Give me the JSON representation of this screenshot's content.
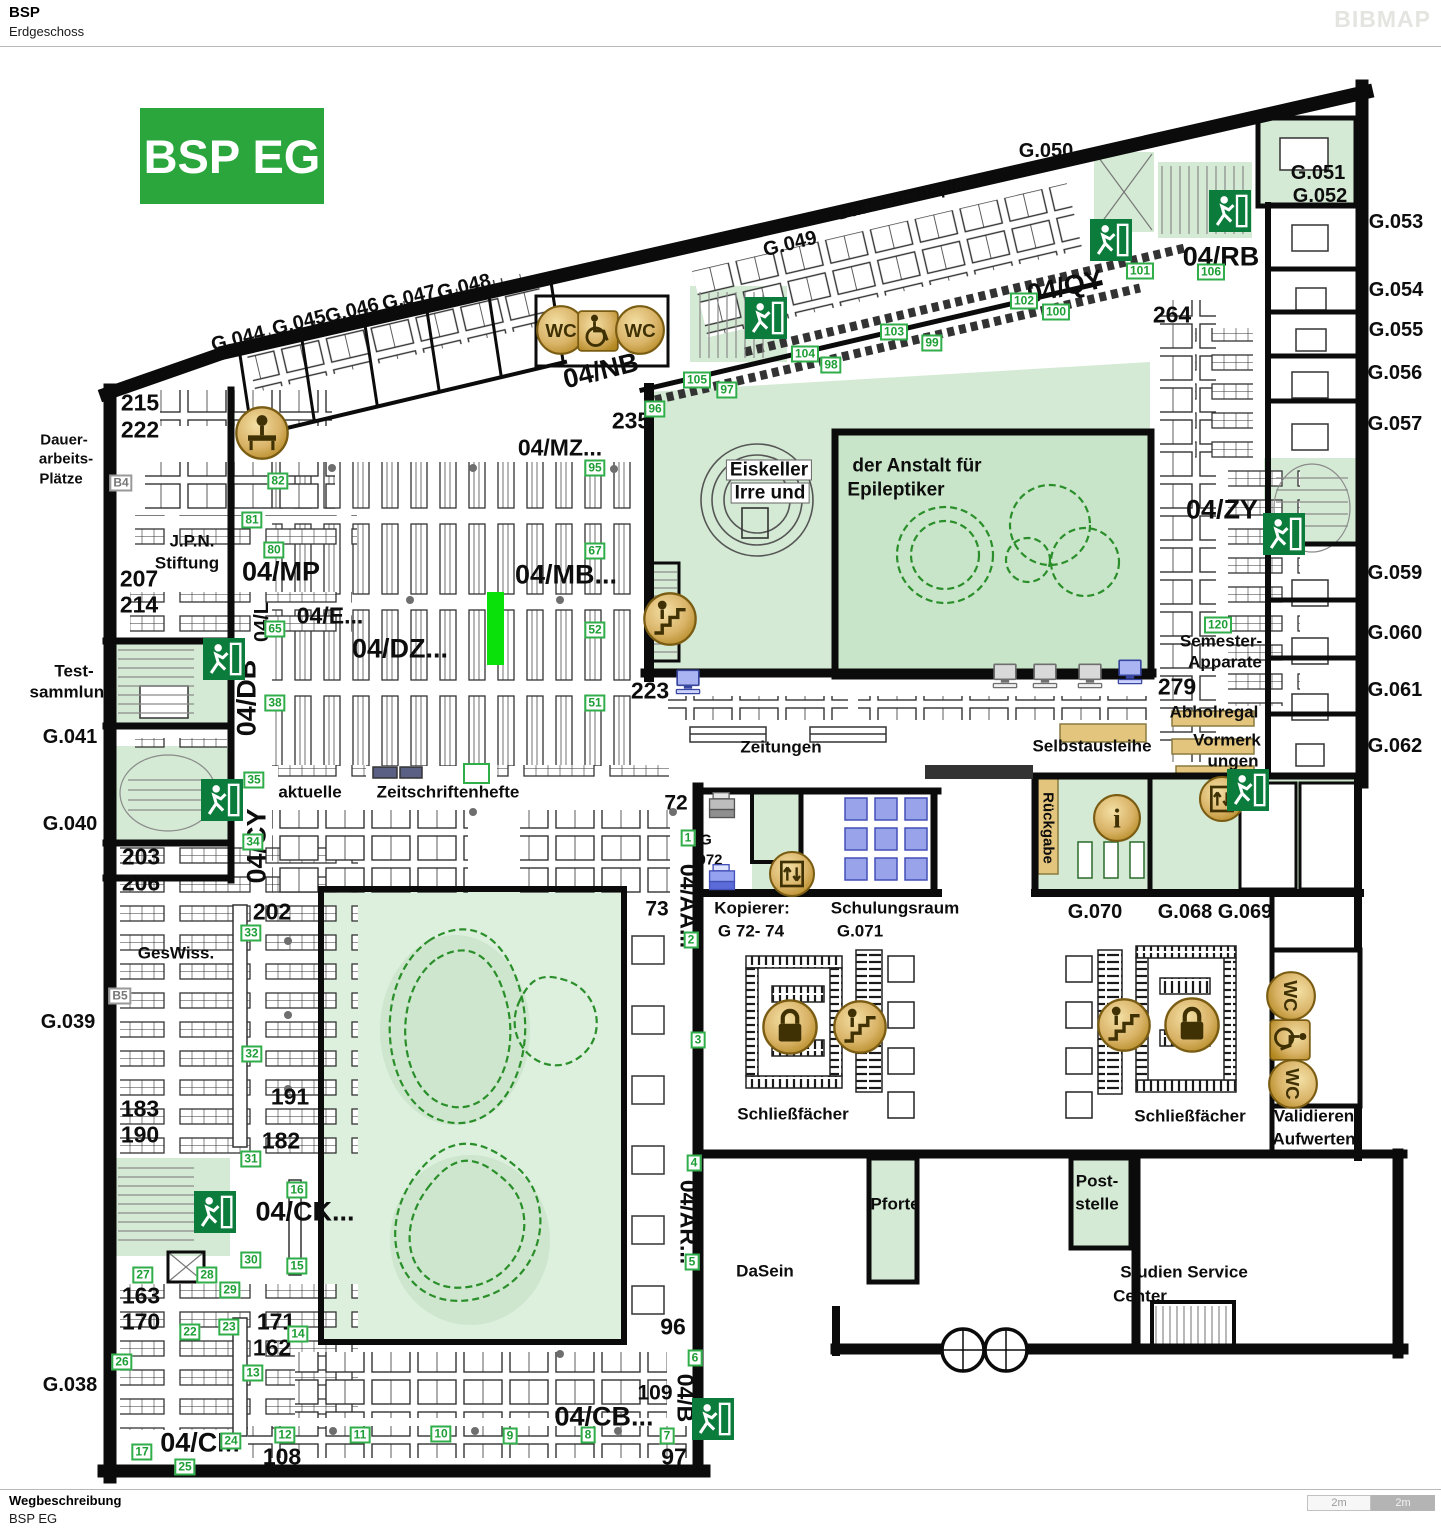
{
  "header": {
    "title": "BSP",
    "subtitle": "Erdgeschoss",
    "logo": "BIBMAP"
  },
  "footer": {
    "heading": "Wegbeschreibung",
    "text": "BSP EG",
    "scale": [
      "2m",
      "2m"
    ]
  },
  "map": {
    "badge": "BSP EG",
    "highlight_color": "#0ae10a",
    "labels": [
      {
        "t": "G.044",
        "x": 238,
        "y": 339,
        "c": "rm",
        "r": -14
      },
      {
        "t": "G.045",
        "x": 299,
        "y": 323,
        "c": "rm",
        "r": -14
      },
      {
        "t": "G.046",
        "x": 352,
        "y": 311,
        "c": "rm",
        "r": -14
      },
      {
        "t": "G.047",
        "x": 409,
        "y": 298,
        "c": "rm",
        "r": -14
      },
      {
        "t": "G.048",
        "x": 464,
        "y": 287,
        "c": "rm",
        "r": -14
      },
      {
        "t": "G.049",
        "x": 790,
        "y": 244,
        "c": "rm",
        "r": -14
      },
      {
        "t": "Dauerarbeitsplätze",
        "x": 912,
        "y": 196,
        "c": "tx",
        "r": -14
      },
      {
        "t": "G.050",
        "x": 1046,
        "y": 151,
        "c": "rm"
      },
      {
        "t": "G.051",
        "x": 1318,
        "y": 173,
        "c": "rm"
      },
      {
        "t": "G.052",
        "x": 1320,
        "y": 196,
        "c": "rm"
      },
      {
        "t": "G.053",
        "x": 1396,
        "y": 222,
        "c": "rm"
      },
      {
        "t": "G.054",
        "x": 1396,
        "y": 290,
        "c": "rm"
      },
      {
        "t": "G.055",
        "x": 1396,
        "y": 330,
        "c": "rm"
      },
      {
        "t": "G.056",
        "x": 1395,
        "y": 373,
        "c": "rm"
      },
      {
        "t": "G.057",
        "x": 1395,
        "y": 424,
        "c": "rm"
      },
      {
        "t": "G.059",
        "x": 1395,
        "y": 573,
        "c": "rm"
      },
      {
        "t": "G.060",
        "x": 1395,
        "y": 633,
        "c": "rm"
      },
      {
        "t": "G.061",
        "x": 1395,
        "y": 690,
        "c": "rm"
      },
      {
        "t": "G.062",
        "x": 1395,
        "y": 746,
        "c": "rm"
      },
      {
        "t": "215",
        "x": 140,
        "y": 403,
        "c": "n1"
      },
      {
        "t": "222",
        "x": 140,
        "y": 430,
        "c": "n1"
      },
      {
        "t": "Dauer-",
        "x": 64,
        "y": 440,
        "c": "t2"
      },
      {
        "t": "arbeits-",
        "x": 66,
        "y": 459,
        "c": "t2"
      },
      {
        "t": "Plätze",
        "x": 61,
        "y": 479,
        "c": "t2"
      },
      {
        "t": "J.P.N.",
        "x": 192,
        "y": 541,
        "c": "tx"
      },
      {
        "t": "Stiftung",
        "x": 187,
        "y": 563,
        "c": "tx"
      },
      {
        "t": "207",
        "x": 139,
        "y": 579,
        "c": "n1"
      },
      {
        "t": "214",
        "x": 139,
        "y": 605,
        "c": "n1"
      },
      {
        "t": "Test-",
        "x": 74,
        "y": 671,
        "c": "tx"
      },
      {
        "t": "sammlung",
        "x": 72,
        "y": 692,
        "c": "tx"
      },
      {
        "t": "G.041",
        "x": 70,
        "y": 737,
        "c": "rm"
      },
      {
        "t": "G.040",
        "x": 70,
        "y": 824,
        "c": "rm"
      },
      {
        "t": "203",
        "x": 141,
        "y": 857,
        "c": "n1"
      },
      {
        "t": "206",
        "x": 141,
        "y": 883,
        "c": "n1"
      },
      {
        "t": "GesWiss.",
        "x": 176,
        "y": 953,
        "c": "tx"
      },
      {
        "t": "G.039",
        "x": 68,
        "y": 1022,
        "c": "rm"
      },
      {
        "t": "183",
        "x": 140,
        "y": 1109,
        "c": "n1"
      },
      {
        "t": "190",
        "x": 140,
        "y": 1135,
        "c": "n1"
      },
      {
        "t": "163",
        "x": 141,
        "y": 1296,
        "c": "n1"
      },
      {
        "t": "170",
        "x": 141,
        "y": 1322,
        "c": "n1"
      },
      {
        "t": "G.038",
        "x": 70,
        "y": 1385,
        "c": "rm"
      },
      {
        "t": "04/NB",
        "x": 601,
        "y": 371,
        "c": "b1",
        "r": -14
      },
      {
        "t": "235",
        "x": 631,
        "y": 421,
        "c": "n1"
      },
      {
        "t": "04/MZ...",
        "x": 560,
        "y": 448,
        "c": "b2"
      },
      {
        "t": "04/QY",
        "x": 1065,
        "y": 287,
        "c": "b1",
        "r": -12
      },
      {
        "t": "04/RB",
        "x": 1221,
        "y": 257,
        "c": "b1"
      },
      {
        "t": "264",
        "x": 1172,
        "y": 315,
        "c": "n1"
      },
      {
        "t": "Eiskeller",
        "x": 769,
        "y": 470,
        "c": "chip"
      },
      {
        "t": "Irre  und",
        "x": 770,
        "y": 493,
        "c": "chip"
      },
      {
        "t": "der Anstalt für",
        "x": 917,
        "y": 466,
        "c": "tx3"
      },
      {
        "t": "Epileptiker",
        "x": 896,
        "y": 490,
        "c": "tx3"
      },
      {
        "t": "04/MP",
        "x": 281,
        "y": 572,
        "c": "b1"
      },
      {
        "t": "04/MB...",
        "x": 566,
        "y": 575,
        "c": "b1"
      },
      {
        "t": "04/E...",
        "x": 330,
        "y": 616,
        "c": "b2"
      },
      {
        "t": "04/DZ...",
        "x": 400,
        "y": 649,
        "c": "b1"
      },
      {
        "t": "04/L",
        "x": 262,
        "y": 622,
        "c": "b3",
        "r": -90
      },
      {
        "t": "04/DB",
        "x": 247,
        "y": 698,
        "c": "b1",
        "r": -90
      },
      {
        "t": "04/CY",
        "x": 257,
        "y": 846,
        "c": "b1",
        "r": -90
      },
      {
        "t": "223",
        "x": 650,
        "y": 691,
        "c": "n1"
      },
      {
        "t": "279",
        "x": 1177,
        "y": 687,
        "c": "n1"
      },
      {
        "t": "04/ZY",
        "x": 1222,
        "y": 510,
        "c": "b1"
      },
      {
        "t": "Semester-",
        "x": 1221,
        "y": 641,
        "c": "tx"
      },
      {
        "t": "Apparate",
        "x": 1225,
        "y": 662,
        "c": "tx"
      },
      {
        "t": "Abholregal",
        "x": 1214,
        "y": 712,
        "c": "tx"
      },
      {
        "t": "Vormerk",
        "x": 1227,
        "y": 740,
        "c": "tx"
      },
      {
        "t": "ungen",
        "x": 1233,
        "y": 761,
        "c": "tx"
      },
      {
        "t": "Selbstausleihe",
        "x": 1092,
        "y": 746,
        "c": "tx"
      },
      {
        "t": "Zeitungen",
        "x": 781,
        "y": 747,
        "c": "tx"
      },
      {
        "t": "aktuelle",
        "x": 310,
        "y": 792,
        "c": "tx"
      },
      {
        "t": "Zeitschriftenhefte",
        "x": 448,
        "y": 792,
        "c": "tx"
      },
      {
        "t": "72",
        "x": 676,
        "y": 803,
        "c": "n2"
      },
      {
        "t": "G",
        "x": 706,
        "y": 840,
        "c": "t2"
      },
      {
        "t": "072",
        "x": 710,
        "y": 860,
        "c": "t2"
      },
      {
        "t": "73",
        "x": 657,
        "y": 909,
        "c": "n2"
      },
      {
        "t": "04/AA...",
        "x": 688,
        "y": 906,
        "c": "b2",
        "r": 90
      },
      {
        "t": "Kopierer:",
        "x": 752,
        "y": 908,
        "c": "tx"
      },
      {
        "t": "G 72- 74",
        "x": 751,
        "y": 931,
        "c": "tx"
      },
      {
        "t": "Schulungsraum",
        "x": 895,
        "y": 908,
        "c": "tx"
      },
      {
        "t": "G.071",
        "x": 860,
        "y": 931,
        "c": "tx"
      },
      {
        "t": "Rückgabe",
        "x": 1048,
        "y": 828,
        "c": "t2",
        "r": 90
      },
      {
        "t": "G.070",
        "x": 1095,
        "y": 912,
        "c": "rm"
      },
      {
        "t": "G.068 G.069",
        "x": 1215,
        "y": 912,
        "c": "rm"
      },
      {
        "t": "Schließfächer",
        "x": 793,
        "y": 1114,
        "c": "tx"
      },
      {
        "t": "Schließfächer",
        "x": 1190,
        "y": 1116,
        "c": "tx"
      },
      {
        "t": "Validieren",
        "x": 1314,
        "y": 1116,
        "c": "tx"
      },
      {
        "t": "Aufwerten",
        "x": 1314,
        "y": 1139,
        "c": "tx"
      },
      {
        "t": "202",
        "x": 272,
        "y": 912,
        "c": "n1"
      },
      {
        "t": "191",
        "x": 290,
        "y": 1097,
        "c": "n1"
      },
      {
        "t": "182",
        "x": 281,
        "y": 1141,
        "c": "n1"
      },
      {
        "t": "04/CK...",
        "x": 305,
        "y": 1212,
        "c": "b1"
      },
      {
        "t": "171",
        "x": 276,
        "y": 1322,
        "c": "n1"
      },
      {
        "t": "162",
        "x": 272,
        "y": 1348,
        "c": "n1"
      },
      {
        "t": "04/CM",
        "x": 200,
        "y": 1443,
        "c": "b1"
      },
      {
        "t": "108",
        "x": 282,
        "y": 1457,
        "c": "n1"
      },
      {
        "t": "04/CB...",
        "x": 604,
        "y": 1417,
        "c": "b1"
      },
      {
        "t": "109",
        "x": 655,
        "y": 1393,
        "c": "n2"
      },
      {
        "t": "97",
        "x": 674,
        "y": 1457,
        "c": "n1"
      },
      {
        "t": "96",
        "x": 673,
        "y": 1327,
        "c": "n1"
      },
      {
        "t": "04/B",
        "x": 685,
        "y": 1398,
        "c": "b2",
        "r": 90
      },
      {
        "t": "04/AR...",
        "x": 688,
        "y": 1222,
        "c": "b2",
        "r": 90
      },
      {
        "t": "Pforte",
        "x": 895,
        "y": 1204,
        "c": "tx"
      },
      {
        "t": "DaSein",
        "x": 765,
        "y": 1271,
        "c": "tx"
      },
      {
        "t": "Post-",
        "x": 1097,
        "y": 1181,
        "c": "tx"
      },
      {
        "t": "stelle",
        "x": 1097,
        "y": 1204,
        "c": "tx"
      },
      {
        "t": "Studien Service",
        "x": 1184,
        "y": 1272,
        "c": "tx"
      },
      {
        "t": "Center",
        "x": 1140,
        "y": 1296,
        "c": "tx"
      }
    ],
    "markers": [
      {
        "t": "82",
        "x": 278,
        "y": 481
      },
      {
        "t": "81",
        "x": 252,
        "y": 520
      },
      {
        "t": "80",
        "x": 274,
        "y": 550
      },
      {
        "t": "95",
        "x": 595,
        "y": 468
      },
      {
        "t": "96",
        "x": 655,
        "y": 409
      },
      {
        "t": "105",
        "x": 697,
        "y": 380
      },
      {
        "t": "97",
        "x": 727,
        "y": 390
      },
      {
        "t": "104",
        "x": 805,
        "y": 354
      },
      {
        "t": "98",
        "x": 831,
        "y": 365
      },
      {
        "t": "103",
        "x": 894,
        "y": 332
      },
      {
        "t": "99",
        "x": 932,
        "y": 343
      },
      {
        "t": "102",
        "x": 1024,
        "y": 301
      },
      {
        "t": "100",
        "x": 1056,
        "y": 312
      },
      {
        "t": "101",
        "x": 1140,
        "y": 271
      },
      {
        "t": "106",
        "x": 1211,
        "y": 272
      },
      {
        "t": "67",
        "x": 595,
        "y": 551
      },
      {
        "t": "52",
        "x": 595,
        "y": 630
      },
      {
        "t": "51",
        "x": 595,
        "y": 703
      },
      {
        "t": "65",
        "x": 275,
        "y": 629
      },
      {
        "t": "38",
        "x": 275,
        "y": 703
      },
      {
        "t": "35",
        "x": 254,
        "y": 780
      },
      {
        "t": "34",
        "x": 253,
        "y": 842
      },
      {
        "t": "33",
        "x": 251,
        "y": 933
      },
      {
        "t": "32",
        "x": 252,
        "y": 1054
      },
      {
        "t": "31",
        "x": 251,
        "y": 1159
      },
      {
        "t": "30",
        "x": 251,
        "y": 1260
      },
      {
        "t": "16",
        "x": 297,
        "y": 1190
      },
      {
        "t": "15",
        "x": 297,
        "y": 1266
      },
      {
        "t": "27",
        "x": 143,
        "y": 1275
      },
      {
        "t": "28",
        "x": 207,
        "y": 1275
      },
      {
        "t": "29",
        "x": 230,
        "y": 1290
      },
      {
        "t": "22",
        "x": 190,
        "y": 1332
      },
      {
        "t": "23",
        "x": 229,
        "y": 1327
      },
      {
        "t": "26",
        "x": 122,
        "y": 1362
      },
      {
        "t": "14",
        "x": 298,
        "y": 1334
      },
      {
        "t": "13",
        "x": 253,
        "y": 1373
      },
      {
        "t": "24",
        "x": 231,
        "y": 1441
      },
      {
        "t": "17",
        "x": 142,
        "y": 1452
      },
      {
        "t": "25",
        "x": 185,
        "y": 1467
      },
      {
        "t": "12",
        "x": 285,
        "y": 1435
      },
      {
        "t": "11",
        "x": 360,
        "y": 1435
      },
      {
        "t": "10",
        "x": 441,
        "y": 1434
      },
      {
        "t": "9",
        "x": 510,
        "y": 1436
      },
      {
        "t": "8",
        "x": 588,
        "y": 1435
      },
      {
        "t": "7",
        "x": 667,
        "y": 1436
      },
      {
        "t": "6",
        "x": 695,
        "y": 1358
      },
      {
        "t": "5",
        "x": 692,
        "y": 1262
      },
      {
        "t": "4",
        "x": 694,
        "y": 1163
      },
      {
        "t": "3",
        "x": 698,
        "y": 1040
      },
      {
        "t": "2",
        "x": 691,
        "y": 940
      },
      {
        "t": "1",
        "x": 688,
        "y": 838
      },
      {
        "t": "120",
        "x": 1218,
        "y": 625
      }
    ],
    "gray_markers": [
      {
        "t": "B4",
        "x": 121,
        "y": 483
      },
      {
        "t": "B5",
        "x": 120,
        "y": 996
      }
    ],
    "icons": [
      {
        "k": "wc",
        "x": 561,
        "y": 330
      },
      {
        "k": "wheelchair",
        "x": 598,
        "y": 331
      },
      {
        "k": "wc",
        "x": 640,
        "y": 330
      },
      {
        "k": "persondesk",
        "x": 262,
        "y": 433
      },
      {
        "k": "stairs",
        "x": 670,
        "y": 619
      },
      {
        "k": "elevator",
        "x": 792,
        "y": 874
      },
      {
        "k": "info",
        "x": 1117,
        "y": 818
      },
      {
        "k": "elevator",
        "x": 1222,
        "y": 799
      },
      {
        "k": "lock",
        "x": 790,
        "y": 1027
      },
      {
        "k": "stairs",
        "x": 860,
        "y": 1027
      },
      {
        "k": "stairs",
        "x": 1124,
        "y": 1025
      },
      {
        "k": "lock",
        "x": 1192,
        "y": 1025
      },
      {
        "k": "wc",
        "x": 1291,
        "y": 996,
        "r": 90
      },
      {
        "k": "wheelchair",
        "x": 1290,
        "y": 1040,
        "r": 90
      },
      {
        "k": "wc",
        "x": 1293,
        "y": 1084,
        "r": 90
      },
      {
        "k": "pc-blue",
        "x": 688,
        "y": 682
      },
      {
        "k": "pc-gray",
        "x": 1005,
        "y": 676
      },
      {
        "k": "pc-gray",
        "x": 1045,
        "y": 676
      },
      {
        "k": "pc-gray",
        "x": 1090,
        "y": 676
      },
      {
        "k": "pc-blue",
        "x": 1130,
        "y": 672
      },
      {
        "k": "copier-gray",
        "x": 722,
        "y": 806
      },
      {
        "k": "copier-blue",
        "x": 722,
        "y": 878
      },
      {
        "k": "exit",
        "x": 766,
        "y": 318
      },
      {
        "k": "exit",
        "x": 1111,
        "y": 240
      },
      {
        "k": "exit",
        "x": 1230,
        "y": 211
      },
      {
        "k": "exit",
        "x": 224,
        "y": 659
      },
      {
        "k": "exit",
        "x": 222,
        "y": 800
      },
      {
        "k": "exit",
        "x": 1284,
        "y": 534
      },
      {
        "k": "exit",
        "x": 1248,
        "y": 790
      },
      {
        "k": "exit",
        "x": 215,
        "y": 1212
      },
      {
        "k": "exit",
        "x": 713,
        "y": 1419
      }
    ]
  }
}
